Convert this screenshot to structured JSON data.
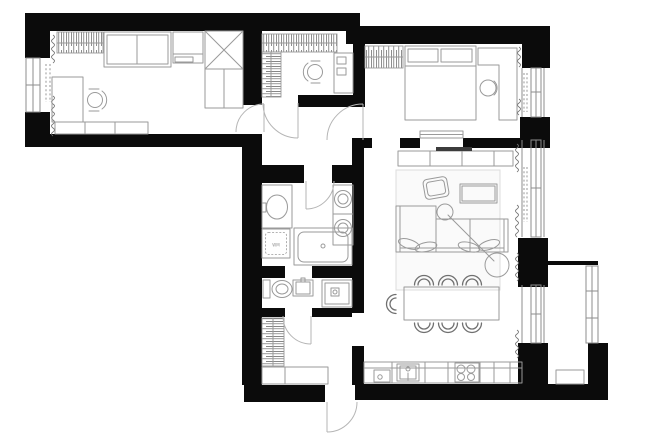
{
  "palette": {
    "background": "#ffffff",
    "wall": "#0b0b0b",
    "line": "#9a9a9a",
    "line_dark": "#707070",
    "window": "#8d8d8d",
    "door": "#b5b5b5",
    "hatch": "#5f5f5f",
    "rug_fill": "#fafafa",
    "rug_stroke": "#dcdcdc",
    "tv": "#3c3c3c",
    "label": "#8f8f8f"
  },
  "labels": {
    "washing_machine": "WM"
  },
  "floorplan": {
    "type": "apartment-floor-plan",
    "canvas": {
      "width": 652,
      "height": 435
    },
    "rooms": [
      {
        "id": "bedroom-office",
        "position": "top-left",
        "furniture": [
          "wardrobe-hatched",
          "daybed",
          "dresser",
          "corner-cabinet",
          "desk",
          "task-chair",
          "low-cabinet"
        ],
        "window": "left-wall",
        "curtains": true,
        "radiator_dashed": true
      },
      {
        "id": "walk-in-closet",
        "position": "top-center",
        "furniture": [
          "hanging-rail-top",
          "hanging-rail-side",
          "vanity-desk",
          "task-chair"
        ]
      },
      {
        "id": "bedroom",
        "position": "top-right",
        "furniture": [
          "wardrobe-hatched",
          "double-bed",
          "two-pillows",
          "corner-desk",
          "stool",
          "tv-console",
          "wall-tv",
          "sliding-door-panel"
        ],
        "window": "right-wall",
        "curtains": true,
        "radiator_dashed": true
      },
      {
        "id": "hallway",
        "position": "center",
        "doors": [
          "to-bedroom-office",
          "to-walk-in-closet",
          "to-bedroom",
          "to-bathroom"
        ]
      },
      {
        "id": "bathroom",
        "position": "center",
        "fixtures": [
          "vanity-counter",
          "oval-sink",
          "washer-dryer-stack",
          "washing-machine",
          "bathtub"
        ]
      },
      {
        "id": "shower-room",
        "position": "center-south",
        "fixtures": [
          "toilet",
          "hand-basin",
          "shower-cabin"
        ]
      },
      {
        "id": "entry-hall",
        "position": "bottom-center",
        "furniture": [
          "wardrobe-hatched",
          "shoe-console"
        ],
        "doors": [
          "entry-door",
          "to-shower-room"
        ]
      },
      {
        "id": "living-dining-kitchen",
        "position": "right",
        "furniture": [
          "rug",
          "armchair",
          "side-table",
          "corner-sofa",
          "sofa-pillows",
          "arc-floor-lamp",
          "dining-table",
          "dining-chairs",
          "kitchen-counter",
          "kitchen-sink",
          "hob-4-burner",
          "small-fixture"
        ],
        "windows": [
          "right-wall-upper",
          "balcony-door"
        ],
        "curtains": true,
        "radiator_dashed": true
      },
      {
        "id": "balcony",
        "position": "bottom-right",
        "furniture": [
          "bench"
        ],
        "glazing": "right-edge"
      }
    ],
    "dining_chairs_count": 7,
    "door_count": 6,
    "window_count": 5
  }
}
